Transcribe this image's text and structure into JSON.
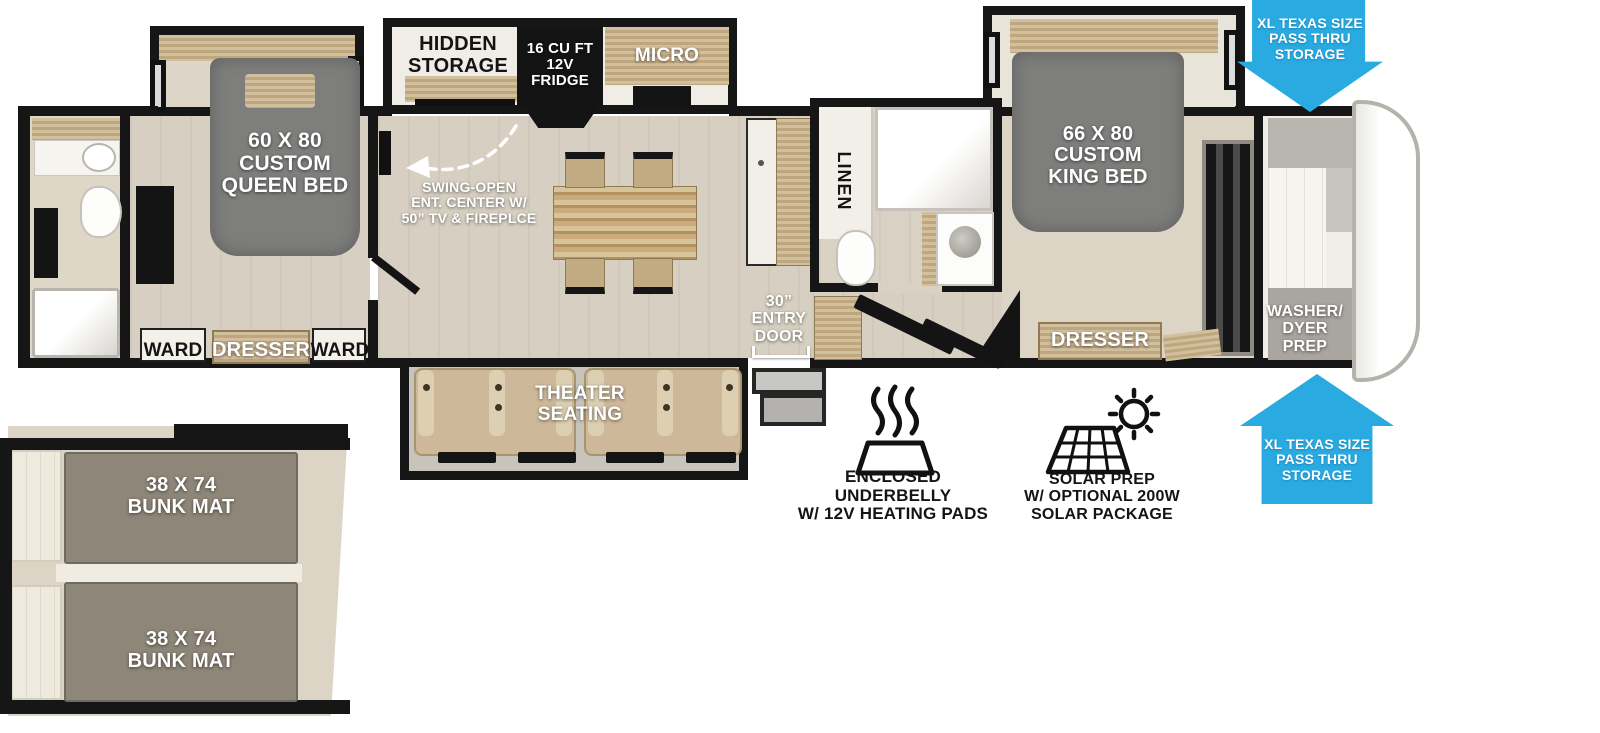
{
  "title": "Fifth wheel RV floorplan diagram",
  "colors": {
    "accent_blue": "#29ABE2",
    "wall_black": "#161616",
    "floor_beige": "#D7D0C2",
    "wood_tan": "#C8B189",
    "mattress_gray": "#7E7E7C",
    "bunk_gray": "#8E8678",
    "seat_tan": "#CDB999"
  },
  "icons": {
    "heating_pads": "heat-waves-in-pan-icon",
    "solar": "solar-panel-with-sun-icon",
    "swing_arrow": "dashed-curved-arrow-icon",
    "pass_thru_top": "down-arrow",
    "pass_thru_bottom": "up-arrow"
  },
  "labels": {
    "hidden_storage": "HIDDEN\nSTORAGE",
    "fridge": "16 CU FT\n12V\nFRIDGE",
    "micro": "MICRO",
    "queen_bed": "60 X 80\nCUSTOM\nQUEEN BED",
    "swing_open_ent": "SWING-OPEN\nENT. CENTER W/\n50” TV & FIREPLCE",
    "ward_left": "WARD",
    "dresser_rear": "DRESSER",
    "ward_right": "WARD",
    "theater_seating": "THEATER\nSEATING",
    "entry_door": "30”\nENTRY\nDOOR",
    "linen": "LINEN",
    "king_bed": "66 X 80\nCUSTOM\nKING BED",
    "dresser_front": "DRESSER",
    "washer_dryer_prep": "WASHER/\nDYER\nPREP",
    "pass_thru_top": "XL TEXAS SIZE\nPASS THRU\nSTORAGE",
    "pass_thru_bottom": "XL TEXAS SIZE\nPASS THRU\nSTORAGE",
    "enclosed_underbelly": "ENCLOSED UNDERBELLY\nW/ 12V HEATING PADS",
    "solar_prep": "SOLAR PREP\nW/ OPTIONAL 200W\nSOLAR PACKAGE",
    "bunk_mat_top": "38 X 74\nBUNK MAT",
    "bunk_mat_bottom": "38 X 74\nBUNK MAT"
  }
}
